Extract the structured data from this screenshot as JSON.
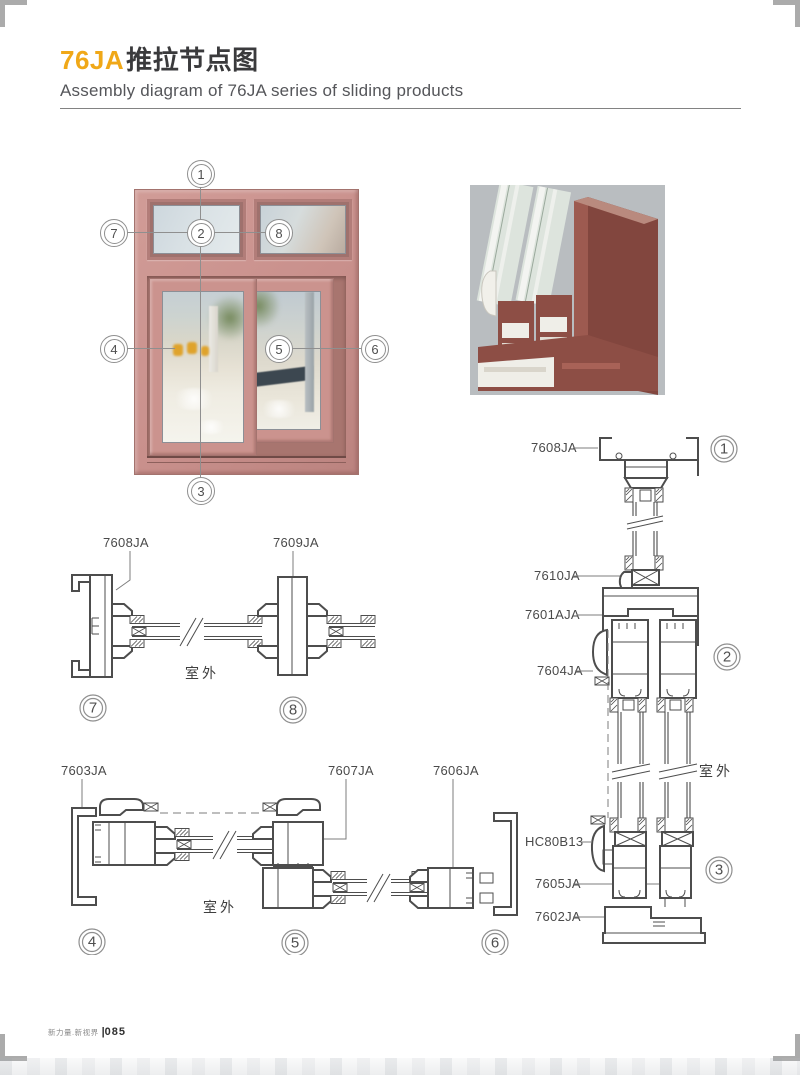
{
  "header": {
    "title_accent": "76JA",
    "title_text": "推拉节点图",
    "subtitle": "Assembly diagram of 76JA series of sliding products"
  },
  "overview": {
    "callouts": [
      "1",
      "2",
      "3",
      "4",
      "5",
      "6",
      "7",
      "8"
    ]
  },
  "sections": {
    "mid": {
      "labels": {
        "left": "7608JA",
        "right": "7609JA"
      },
      "outdoor": "室外",
      "callouts": {
        "left": "7",
        "right": "8"
      }
    },
    "bottom": {
      "labels": {
        "left": "7603JA",
        "center": "7607JA",
        "right": "7606JA"
      },
      "outdoor": "室外",
      "callouts": {
        "left": "4",
        "center": "5",
        "right": "6"
      }
    },
    "right": {
      "labels": {
        "head": "7608JA",
        "bead": "7610JA",
        "transom": "7601AJA",
        "hook": "7604JA",
        "lock": "HC80B13",
        "sash": "7605JA",
        "sill": "7602JA"
      },
      "outdoor": "室外",
      "callouts": {
        "top": "1",
        "middle": "2",
        "bottom": "3"
      }
    }
  },
  "footer": {
    "brand": "新力量.新视界",
    "sep": "|",
    "page": "085"
  },
  "colors": {
    "accent": "#F0A818",
    "window_frame": "#C9908C",
    "profile_red": "#8D4E45",
    "drawing_stroke": "#4D4D4D"
  }
}
